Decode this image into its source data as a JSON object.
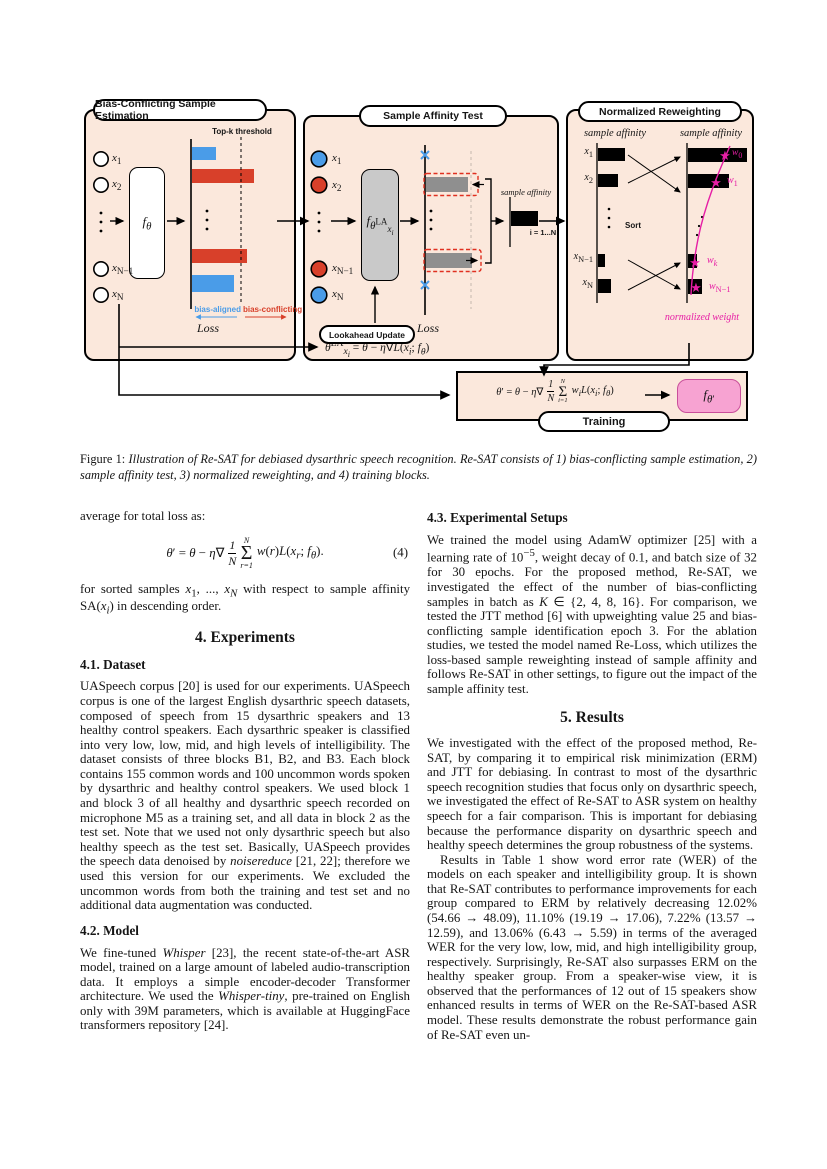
{
  "figure": {
    "panel1": {
      "title": "Bias-Conflicting Sample Estimation",
      "inputs": [
        "<i>x</i><sub>1</sub>",
        "<i>x</i><sub>2</sub>",
        "<i>x</i><sub>N−1</sub>",
        "<i>x</i><sub>N</sub>"
      ],
      "model": "<i>f<sub>θ</sub></i>",
      "topk_label": "Top-k threshold",
      "bias_aligned": "bias-aligned",
      "bias_conflicting": "bias-conflicting",
      "loss_label": "Loss"
    },
    "panel2": {
      "title": "Sample Affinity Test",
      "inputs": [
        "<i>x</i><sub>1</sub>",
        "<i>x</i><sub>2</sub>",
        "<i>x</i><sub>N−1</sub>",
        "<i>x</i><sub>N</sub>"
      ],
      "model": "<i>f</i><sub><i>θ</i><sup>LA</sup><sub><i>x<sub>i</sub></i></sub></sub>",
      "sample_affinity_label": "sample affinity",
      "index_label": "i = 1...N",
      "lookahead_label": "Lookahead Update",
      "formula": "<i>θ</i><sup>LA</sup><sub><i>x<sub>i</sub></i></sub> = <i>θ</i> − <i>η</i>∇<i>L</i>(<i>x<sub>i</sub></i>; <i>f<sub>θ</sub></i>)",
      "loss_label": "Loss"
    },
    "panel3": {
      "title": "Normalized Reweighting",
      "left_header": "sample affinity",
      "right_header": "sample affinity",
      "labels": [
        "<i>x</i><sub>1</sub>",
        "<i>x</i><sub>2</sub>",
        "<i>x</i><sub>N−1</sub>",
        "<i>x</i><sub>N</sub>"
      ],
      "sort_label": "Sort",
      "weights": [
        "<i>w</i><sub>0</sub>",
        "<i>w</i><sub>1</sub>",
        "<i>w<sub>k</sub></i>",
        "<i>w</i><sub>N−1</sub>"
      ],
      "normalized_label": "normalized weight",
      "star_glyph": "★"
    },
    "training": {
      "label": "Training",
      "model": "<i>f</i><sub><i>θ</i>′</sub>",
      "formula": {
        "lhs": "<i>θ</i>′ = <i>θ</i> − <i>η</i>∇",
        "frac_num": "1",
        "frac_den": "N",
        "sum_sup": "N",
        "sum_sub": "i=1",
        "rhs": "<i>w<sub>i</sub></i><i>L</i>(<i>x<sub>i</sub></i>; <i>f<sub>θ</sub></i>)"
      }
    }
  },
  "caption": {
    "prefix": "Figure 1:",
    "text": "Illustration of Re-SAT for debiased dysarthric speech recognition. Re-SAT consists of 1) bias-conflicting sample estimation, 2) sample affinity test, 3) normalized reweighting, and 4) training blocks."
  },
  "left_column": {
    "intro": "average for total loss as:",
    "eq4": {
      "lhs": "<i>θ</i>′ = <i>θ</i> − <i>η</i>∇",
      "frac_num": "1",
      "frac_den": "N",
      "sum_sup": "N",
      "sum_sub": "r=1",
      "rhs": "<i>w</i>(<i>r</i>)<i>L</i>(<i>x<sub>r</sub></i>; <i>f<sub>θ</sub></i>).",
      "tag": "(4)"
    },
    "after_eq": "for sorted samples <i>x</i><sub>1</sub>, ..., <i>x<sub>N</sub></i> with respect to sample affinity SA(<i>x<sub>i</sub></i>) in descending order.",
    "sec4_title": "4. Experiments",
    "sec41_title": "4.1. Dataset",
    "dataset_text": "UASpeech corpus [20] is used for our experiments. UASpeech corpus is one of the largest English dysarthric speech datasets, composed of speech from 15 dysarthric speakers and 13 healthy control speakers. Each dysarthric speaker is classified into very low, low, mid, and high levels of intelligibility. The dataset consists of three blocks B1, B2, and B3. Each block contains 155 common words and 100 uncommon words spoken by dysarthric and healthy control speakers. We used block 1 and block 3 of all healthy and dysarthric speech recorded on microphone M5 as a training set, and all data in block 2 as the test set. Note that we used not only dysarthric speech but also healthy speech as the test set. Basically, UASpeech provides the speech data denoised by <i>noisereduce</i> [21, 22]; therefore we used this version for our experiments. We excluded the uncommon words from both the training and test set and no additional data augmentation was conducted.",
    "sec42_title": "4.2. Model",
    "model_text": "We fine-tuned <i>Whisper</i> [23], the recent state-of-the-art ASR model, trained on a large amount of labeled audio-transcription data. It employs a simple encoder-decoder Transformer architecture. We used the <i>Whisper-tiny</i>, pre-trained on English only with 39M parameters, which is available at HuggingFace transformers repository [24]."
  },
  "right_column": {
    "sec43_title": "4.3. Experimental Setups",
    "setups_text": "We trained the model using AdamW optimizer [25] with a learning rate of 10<sup>−5</sup>, weight decay of 0.1, and batch size of 32 for 30 epochs. For the proposed method, Re-SAT, we investigated the effect of the number of bias-conflicting samples in batch as <i>K</i> ∈ {2, 4, 8, 16}. For comparison, we tested the JTT method [6] with upweighting value 25 and bias-conflicting sample identification epoch 3. For the ablation studies, we tested the model named Re-Loss, which utilizes the loss-based sample reweighting instead of sample affinity and follows Re-SAT in other settings, to figure out the impact of the sample affinity test.",
    "sec5_title": "5. Results",
    "results_p1": "We investigated with the effect of the proposed method, Re-SAT, by comparing it to empirical risk minimization (ERM) and JTT for debiasing. In contrast to most of the dysarthric speech recognition studies that focus only on dysarthric speech, we investigated the effect of Re-SAT to ASR system on healthy speech for a fair comparison. This is important for debiasing because the performance disparity on dysarthric speech and healthy speech determines the group robustness of the systems.",
    "results_p2": "Results in Table 1 show word error rate (WER) of the models on each speaker and intelligibility group. It is shown that Re-SAT contributes to performance improvements for each group compared to ERM by relatively decreasing 12.02% (54.66 → 48.09), 11.10% (19.19 → 17.06), 7.22% (13.57 → 12.59), and 13.06% (6.43 → 5.59) in terms of the averaged WER for the very low, low, mid, and high intelligibility group, respectively. Surprisingly, Re-SAT also surpasses ERM on the healthy speaker group. From a speaker-wise view, it is observed that the performances of 12 out of 15 speakers show enhanced results in terms of WER on the Re-SAT-based ASR model. These results demonstrate the robust performance gain of Re-SAT even un-"
  },
  "colors": {
    "panel_bg": "#fbe8dc",
    "bar_blue": "#4a9ce8",
    "bar_red": "#d8402a",
    "model_gray": "#c9c9c9",
    "magenta": "#e61ea5",
    "pink_box": "#f7a3d2"
  }
}
